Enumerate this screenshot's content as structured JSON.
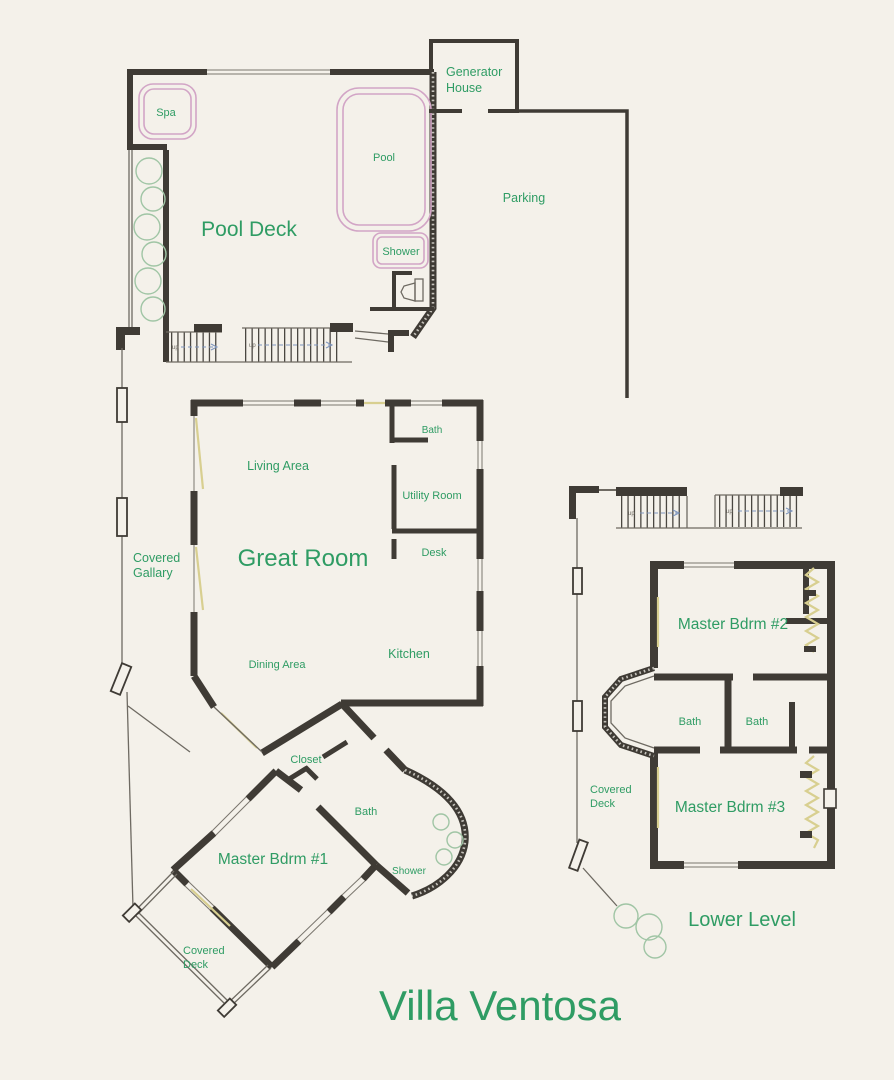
{
  "title": "Villa Ventosa",
  "colors": {
    "background": "#f4f1ea",
    "wall": "#3f3b35",
    "label_green": "#2f9c64",
    "pool_pink": "#d2a5c6",
    "tree_green": "#a0c5a5",
    "door_yellow": "#d8cf90",
    "stair_blue": "#7e95bd"
  },
  "labels": {
    "spa": "Spa",
    "pool": "Pool",
    "pool_deck": "Pool Deck",
    "shower_top": "Shower",
    "generator_house_line1": "Generator",
    "generator_house_line2": "House",
    "parking": "Parking",
    "bath_main": "Bath",
    "living_area": "Living Area",
    "utility_room": "Utility Room",
    "great_room": "Great Room",
    "desk": "Desk",
    "covered_gallary_line1": "Covered",
    "covered_gallary_line2": "Gallary",
    "dining_area": "Dining Area",
    "kitchen": "Kitchen",
    "closet": "Closet",
    "bath_suite": "Bath",
    "master_bdrm1": "Master Bdrm #1",
    "shower_suite": "Shower",
    "covered_deck1_line1": "Covered",
    "covered_deck1_line2": "Deck",
    "master_bdrm2": "Master Bdrm #2",
    "bath_lower1": "Bath",
    "bath_lower2": "Bath",
    "master_bdrm3": "Master Bdrm #3",
    "covered_deck2_line1": "Covered",
    "covered_deck2_line2": "Deck",
    "lower_level": "Lower Level",
    "stairs_up": "up"
  }
}
